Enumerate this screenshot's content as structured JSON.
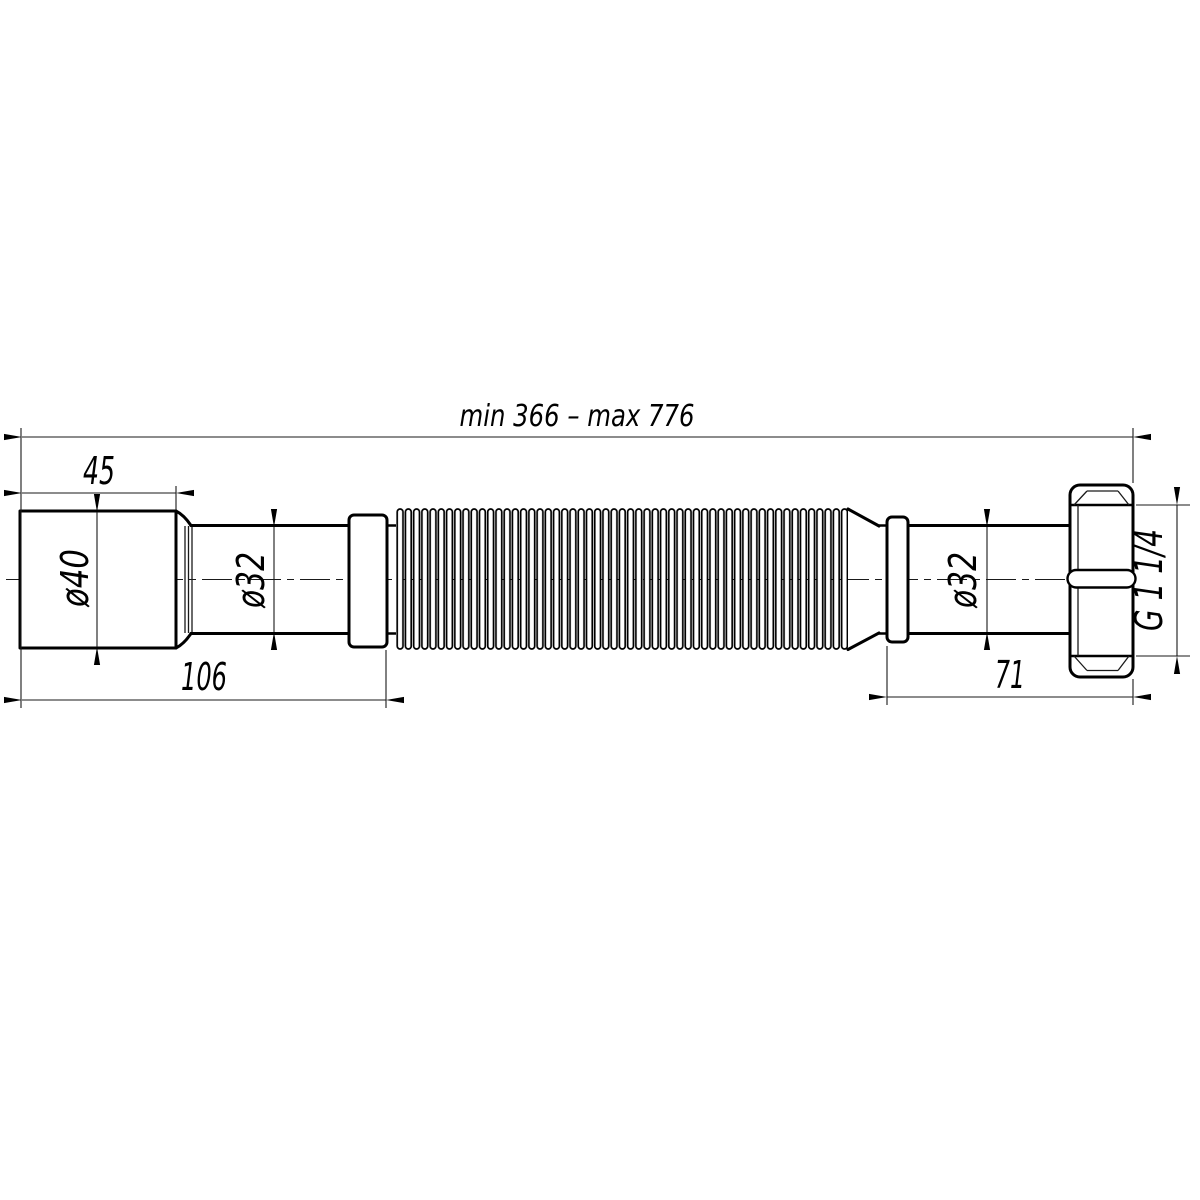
{
  "drawing": {
    "background_color": "#ffffff",
    "line_color": "#000000",
    "labels": {
      "overall_length": "min 366 – max 776",
      "inlet_length": "45",
      "left_assembly_length": "106",
      "right_assembly_length": "71",
      "inlet_diameter": "ø40",
      "left_pipe_diameter": "ø32",
      "right_pipe_diameter": "ø32",
      "nut_thread_size": "G 1 1/4"
    }
  }
}
